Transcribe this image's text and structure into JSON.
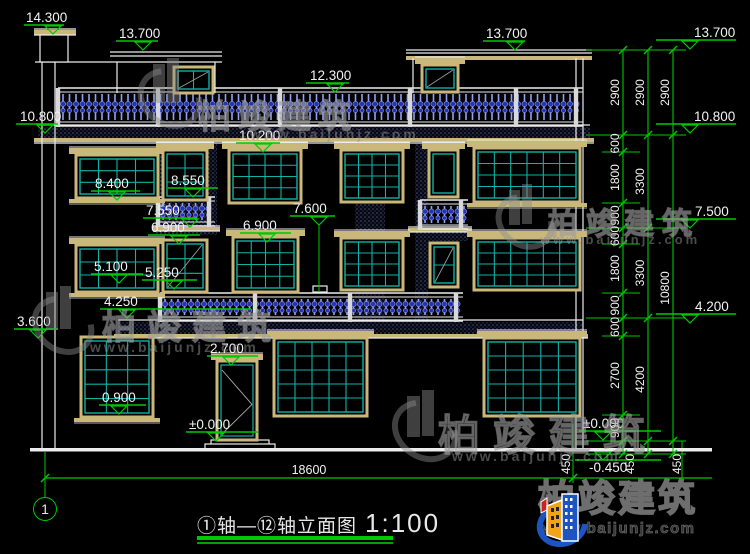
{
  "meta": {
    "width": 750,
    "height": 554,
    "background": "#000000"
  },
  "palette": {
    "line_white": "#ececec",
    "annotation_green": "#00c800",
    "glass_cyan": "#10b2a6",
    "frame_tan": "#c9b87a",
    "baluster_blue": "#2633b8",
    "baluster_highlight": "#93a0f5",
    "stipple_dot": "#474f7d",
    "text_white": "#f2f2f2",
    "brand_blue": "#1d54c0",
    "brand_yellow": "#f0a41b",
    "brand_red": "#cc2222"
  },
  "title_block": {
    "title": "①轴—⑫轴立面图",
    "scale": "1:100"
  },
  "axis_bubble": {
    "label": "1"
  },
  "brand": {
    "name": "柏竣建筑",
    "url": "www.baijunjz.com"
  },
  "watermark": {
    "name": "柏竣建筑",
    "url": "www.baijunjz.com",
    "instances": [
      {
        "gx": 198,
        "gy": 90,
        "gs": 33,
        "gls": 7,
        "ux": 250,
        "uy": 126,
        "us": 14,
        "ax": 136,
        "ay": 70,
        "ad": 56
      },
      {
        "gx": 548,
        "gy": 199,
        "gs": 30,
        "gls": 8,
        "ux": 540,
        "uy": 232,
        "us": 13,
        "ax": 494,
        "ay": 196,
        "ad": 50
      },
      {
        "gx": 102,
        "gy": 300,
        "gs": 34,
        "gls": 11,
        "ux": 90,
        "uy": 339,
        "us": 14,
        "ax": 30,
        "ay": 298,
        "ad": 54
      },
      {
        "gx": 438,
        "gy": 402,
        "gs": 42,
        "gls": 13,
        "ux": 452,
        "uy": 448,
        "us": 14,
        "ax": 390,
        "ay": 402,
        "ad": 58
      }
    ]
  },
  "dim_overall": {
    "label": "18600",
    "y": 478,
    "x1": 45,
    "x2": 712,
    "tick1": 45,
    "tick2": 573,
    "text_x": 309,
    "text_y": 474
  },
  "chains": [
    {
      "x": 623,
      "bounds": [
        50,
        135,
        152,
        203,
        228,
        244,
        293,
        318,
        336,
        415,
        441,
        454
      ],
      "labels": [
        "2900",
        "600",
        "1800",
        "900",
        "600",
        "1800",
        "900",
        "600",
        "2700",
        "900",
        "450"
      ]
    },
    {
      "x": 648,
      "bounds": [
        50,
        135,
        228,
        318,
        441,
        454
      ],
      "labels": [
        "2900",
        "3300",
        "3300",
        "4200",
        "450"
      ]
    },
    {
      "x": 673,
      "bounds": [
        50,
        135,
        441,
        454
      ],
      "labels": [
        "2900",
        "10800",
        "450"
      ]
    }
  ],
  "chain_bottom_labels": [
    {
      "t": "450",
      "x": 570,
      "y": 464
    },
    {
      "t": "450",
      "x": 634,
      "y": 464
    },
    {
      "t": "450",
      "x": 681,
      "y": 464
    }
  ],
  "ext_lines": {
    "long_y": [
      50,
      135,
      228,
      318,
      441,
      454
    ],
    "long_x": [
      586,
      686
    ],
    "short_y": [
      152,
      203,
      244,
      293,
      336,
      415
    ],
    "short_x": [
      602,
      640
    ]
  },
  "levels": [
    {
      "t": "14.300",
      "x": 26,
      "y": 22,
      "u": [
        24,
        64
      ],
      "c": 53
    },
    {
      "t": "13.700",
      "x": 119,
      "y": 38,
      "u": [
        116,
        158
      ],
      "c": 143
    },
    {
      "t": "12.300",
      "x": 310,
      "y": 80,
      "u": [
        306,
        349
      ],
      "c": 335
    },
    {
      "t": "13.700",
      "x": 486,
      "y": 38,
      "u": [
        483,
        525
      ],
      "c": 515
    },
    {
      "t": "13.700",
      "x": 694,
      "y": 37,
      "u": [
        656,
        736
      ],
      "c": 690
    },
    {
      "t": "10.800",
      "x": 20,
      "y": 121,
      "u": [
        16,
        58
      ],
      "c": 45
    },
    {
      "t": "10.800",
      "x": 694,
      "y": 121,
      "u": [
        656,
        736
      ],
      "c": 690
    },
    {
      "t": "10.200",
      "x": 239,
      "y": 140,
      "u": [
        236,
        280
      ],
      "c": 263
    },
    {
      "t": "8.400",
      "x": 95,
      "y": 188,
      "u": [
        91,
        140
      ],
      "c": 117
    },
    {
      "t": "8.550",
      "x": 171,
      "y": 185,
      "u": [
        168,
        218
      ],
      "c": 193
    },
    {
      "t": "7.550",
      "x": 146,
      "y": 215,
      "u": [
        143,
        197
      ],
      "c": 190
    },
    {
      "t": "6.900",
      "x": 151,
      "y": 232,
      "u": [
        148,
        200
      ],
      "c": 179
    },
    {
      "t": "6.900",
      "x": 243,
      "y": 230,
      "u": [
        240,
        291
      ],
      "c": 267
    },
    {
      "t": "7.600",
      "x": 293,
      "y": 213,
      "u": [
        290,
        335
      ],
      "c": 319
    },
    {
      "t": "5.100",
      "x": 94,
      "y": 271,
      "u": [
        91,
        143
      ],
      "c": 119
    },
    {
      "t": "5.250",
      "x": 145,
      "y": 277,
      "u": [
        142,
        197
      ],
      "c": 174
    },
    {
      "t": "4.250",
      "x": 104,
      "y": 306,
      "u": [
        100,
        251
      ],
      "c": 127
    },
    {
      "t": "3.600",
      "x": 17,
      "y": 326,
      "u": [
        14,
        58
      ],
      "c": 38
    },
    {
      "t": "2.700",
      "x": 210,
      "y": 353,
      "u": [
        207,
        258
      ],
      "c": 231
    },
    {
      "t": "0.900",
      "x": 102,
      "y": 402,
      "u": [
        99,
        146
      ],
      "c": 119
    },
    {
      "t": "±0.000",
      "x": 189,
      "y": 429,
      "u": [
        186,
        258
      ],
      "c": 216
    },
    {
      "t": "7.500",
      "x": 695,
      "y": 216,
      "u": [
        656,
        736
      ],
      "c": 690
    },
    {
      "t": "4.200",
      "x": 695,
      "y": 311,
      "u": [
        656,
        736
      ],
      "c": 690
    },
    {
      "t": "±0.000",
      "x": 583,
      "y": 428,
      "u": [
        579,
        661
      ],
      "c": 603
    },
    {
      "t": "-0.450",
      "x": 589,
      "y": 472,
      "u": [
        575,
        661
      ],
      "c": 603,
      "flip": true
    }
  ],
  "elevation": {
    "ground_bar": [
      30,
      448,
      682,
      3.5
    ],
    "white_lines": [
      [
        42,
        62,
        42,
        448
      ],
      [
        55,
        62,
        55,
        448
      ],
      [
        576,
        58,
        576,
        448
      ],
      [
        583,
        58,
        583,
        448
      ],
      [
        117,
        62,
        117,
        93
      ],
      [
        215,
        62,
        215,
        93
      ],
      [
        110,
        52,
        222,
        52
      ],
      [
        110,
        56,
        222,
        56
      ],
      [
        35,
        62,
        222,
        62
      ],
      [
        413,
        58,
        413,
        93
      ],
      [
        406,
        50,
        592,
        50
      ],
      [
        406,
        53,
        592,
        53
      ],
      [
        34,
        29,
        76,
        29
      ],
      [
        34,
        35,
        76,
        35
      ],
      [
        38,
        125,
        590,
        125
      ],
      [
        34,
        143,
        594,
        143
      ],
      [
        118,
        320,
        583,
        320
      ],
      [
        114,
        338,
        588,
        338
      ],
      [
        153,
        226,
        220,
        226
      ],
      [
        153,
        231,
        220,
        231
      ],
      [
        408,
        227,
        472,
        227
      ],
      [
        408,
        232,
        472,
        232
      ]
    ],
    "green_lines": [
      [
        319,
        224,
        319,
        292
      ],
      [
        45,
        452,
        45,
        497
      ],
      [
        573,
        424,
        573,
        483
      ],
      [
        682,
        441,
        682,
        483
      ]
    ],
    "stipple_rects": [
      [
        38,
        127,
        552,
        11
      ],
      [
        118,
        322,
        465,
        12
      ],
      [
        155,
        140,
        62,
        95
      ],
      [
        355,
        128,
        30,
        193
      ],
      [
        415,
        128,
        13,
        193
      ],
      [
        428,
        225,
        40,
        16
      ]
    ],
    "tan_rects": [
      [
        34,
        138,
        560,
        4
      ],
      [
        114,
        334,
        474,
        4
      ],
      [
        406,
        56,
        186,
        4
      ],
      [
        34,
        30,
        42,
        5
      ],
      [
        153,
        227,
        67,
        4
      ],
      [
        408,
        228,
        64,
        4
      ]
    ],
    "outline_rects": [
      [
        40,
        35,
        28,
        27
      ],
      [
        211,
        440,
        58,
        5
      ],
      [
        205,
        444,
        70,
        5
      ],
      [
        313,
        286,
        14,
        6
      ]
    ],
    "balustrades": [
      {
        "x": 58,
        "y": 88,
        "w": 525,
        "h": 39,
        "posts": [
          58,
          158,
          280,
          410,
          516,
          576
        ]
      },
      {
        "x": 160,
        "y": 293,
        "w": 303,
        "h": 29,
        "posts": [
          160,
          255,
          350,
          456
        ]
      },
      {
        "x": 158,
        "y": 197,
        "w": 57,
        "h": 30,
        "posts": [
          158,
          209
        ]
      },
      {
        "x": 420,
        "y": 200,
        "w": 48,
        "h": 30,
        "posts": [
          420,
          461
        ]
      }
    ],
    "windows": [
      {
        "x": 76,
        "y": 155,
        "w": 82,
        "h": 43,
        "cols": 4,
        "rows": 3,
        "cornice": true,
        "sill": true
      },
      {
        "x": 163,
        "y": 150,
        "w": 44,
        "h": 50,
        "cols": 2,
        "rows": 3,
        "cornice": true
      },
      {
        "x": 229,
        "y": 150,
        "w": 72,
        "h": 53,
        "cols": 4,
        "rows": 4,
        "cornice": true
      },
      {
        "x": 341,
        "y": 150,
        "w": 62,
        "h": 52,
        "cols": 4,
        "rows": 4,
        "cornice": true
      },
      {
        "x": 429,
        "y": 150,
        "w": 29,
        "h": 47,
        "cols": 1,
        "rows": 1,
        "cornice": true
      },
      {
        "x": 474,
        "y": 148,
        "w": 106,
        "h": 54,
        "cols": 6,
        "rows": 4,
        "cornice": true,
        "sill": true
      },
      {
        "x": 76,
        "y": 245,
        "w": 82,
        "h": 47,
        "cols": 4,
        "rows": 3,
        "cornice": true,
        "sill": true
      },
      {
        "x": 163,
        "y": 240,
        "w": 44,
        "h": 52,
        "cols": 2,
        "rows": 3,
        "diag": true
      },
      {
        "x": 233,
        "y": 237,
        "w": 65,
        "h": 55,
        "cols": 4,
        "rows": 4,
        "cornice": true
      },
      {
        "x": 341,
        "y": 238,
        "w": 62,
        "h": 52,
        "cols": 4,
        "rows": 4,
        "cornice": true
      },
      {
        "x": 430,
        "y": 243,
        "w": 28,
        "h": 44,
        "cols": 1,
        "rows": 2,
        "diag": true
      },
      {
        "x": 474,
        "y": 238,
        "w": 106,
        "h": 52,
        "cols": 6,
        "rows": 4,
        "cornice": true
      },
      {
        "x": 81,
        "y": 337,
        "w": 72,
        "h": 80,
        "cols": 3,
        "rows": 5,
        "sill": true
      },
      {
        "x": 274,
        "y": 338,
        "w": 93,
        "h": 78,
        "cols": 5,
        "rows": 5,
        "cornice": true
      },
      {
        "x": 484,
        "y": 338,
        "w": 96,
        "h": 78,
        "cols": 5,
        "rows": 5,
        "cornice": true
      },
      {
        "x": 174,
        "y": 67,
        "w": 39,
        "h": 26,
        "cols": 2,
        "rows": 1,
        "diag": true
      },
      {
        "x": 422,
        "y": 65,
        "w": 36,
        "h": 27,
        "cols": 1,
        "rows": 1,
        "diag": true,
        "cornice": true
      }
    ],
    "door": {
      "x": 217,
      "y": 361,
      "w": 40,
      "h": 79
    }
  }
}
